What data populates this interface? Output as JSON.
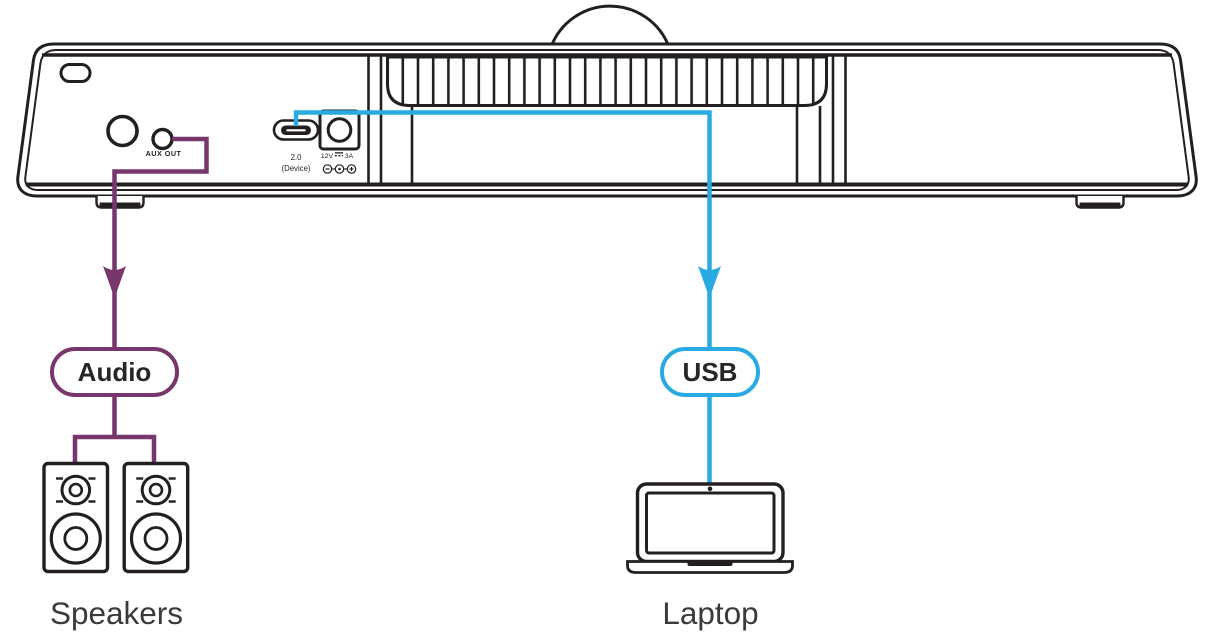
{
  "device": {
    "ports": {
      "aux_out_label": "AUX OUT",
      "usbc_label_line1": "2.0",
      "usbc_label_line2": "(Device)",
      "power_voltage": "12V",
      "power_current": "3A",
      "power_polarity_symbol": "⊖–⊙–⊕"
    }
  },
  "connections": {
    "audio": {
      "label": "Audio",
      "color": "#77366C",
      "from_port": "AUX OUT",
      "to_device": "Speakers"
    },
    "usb": {
      "label": "USB",
      "color": "#29ABE2",
      "from_port": "USB 2.0 (Device)",
      "to_device": "Laptop"
    }
  },
  "endpoints": {
    "speakers_label": "Speakers",
    "laptop_label": "Laptop"
  }
}
